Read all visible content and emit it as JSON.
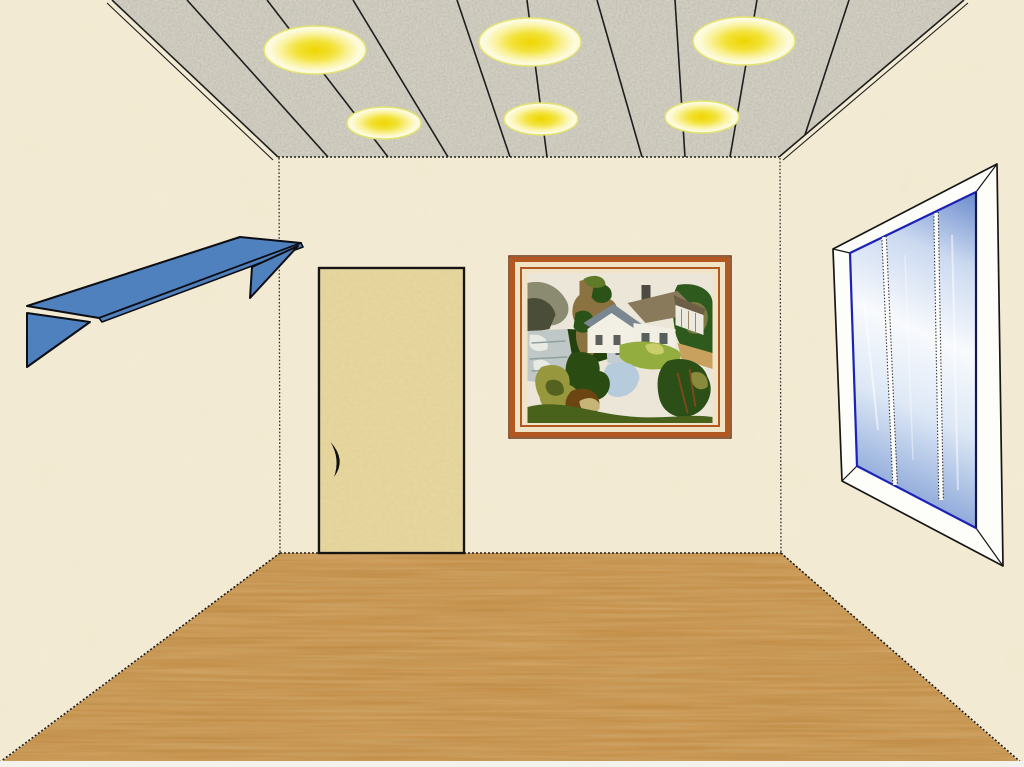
{
  "scene": {
    "kind": "clipart-room-interior-illustration",
    "objects": [
      "ceiling-with-recessed-lights",
      "blue-wall-shelf",
      "wooden-door",
      "framed-cottage-landscape-picture",
      "perspective-window",
      "wood-plank-floor"
    ]
  },
  "counts": {
    "ceiling_lights_large": 3,
    "ceiling_lights_small": 3,
    "ceiling_plank_lines": 9,
    "window_panes": 3,
    "shelf_brackets": 2
  },
  "colors": {
    "margin": "#f3f2ec",
    "wall": "#f3ebd4",
    "ceiling": "#dbd7ca",
    "ceiling_line": "#1e1e1e",
    "light_core": "#eed600",
    "light_rim": "#e3e370",
    "floor": "#c4893f",
    "floor_grain_dark": "#7c4c16",
    "door": "#e8d9a1",
    "door_outline": "#151515",
    "door_handle": "#111111",
    "shelf": "#4e81bd",
    "shelf_outline": "#0d0d14",
    "frame_matte": "#f0e3c6",
    "frame_band": "#b2571f",
    "frame_outline": "#6b3414",
    "window_frame": "#fdfdfa",
    "window_outline": "#161616",
    "glass_edge": "#1c22b5",
    "glass_blue": "#8ea9d9",
    "glass_white": "#f8fafd",
    "corner_line": "#2e2e2e"
  }
}
